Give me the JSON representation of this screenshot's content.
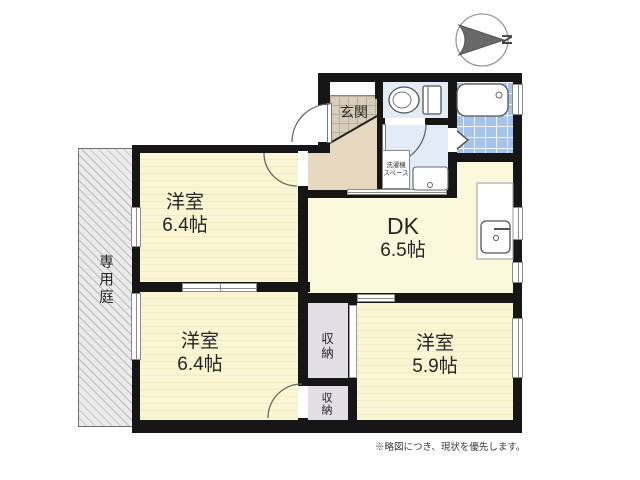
{
  "compass": {
    "letter": "N"
  },
  "rooms": {
    "bedroom_top_left": {
      "name": "洋室",
      "size": "6.4帖"
    },
    "bedroom_bottom_left": {
      "name": "洋室",
      "size": "6.4帖"
    },
    "bedroom_right": {
      "name": "洋室",
      "size": "5.9帖"
    },
    "dining_kitchen": {
      "name": "DK",
      "size": "6.5帖"
    },
    "entrance": {
      "label": "玄関"
    },
    "closet_upper": {
      "label": "収納"
    },
    "closet_lower": {
      "label": "収納"
    },
    "laundry_space": {
      "line1": "洗濯機",
      "line2": "スペース"
    },
    "private_garden": {
      "label": "専用庭"
    }
  },
  "footnote": "※略図につき、現状を優先します。",
  "colors": {
    "wall": "#161616",
    "room_yellow": "#faf6d3",
    "hallway_beige": "#e6d9c0",
    "wet_area_blue": "#e3ebf6",
    "bath_tile_blue": "#a6c4ea",
    "closet_gray": "#e2dee6"
  }
}
